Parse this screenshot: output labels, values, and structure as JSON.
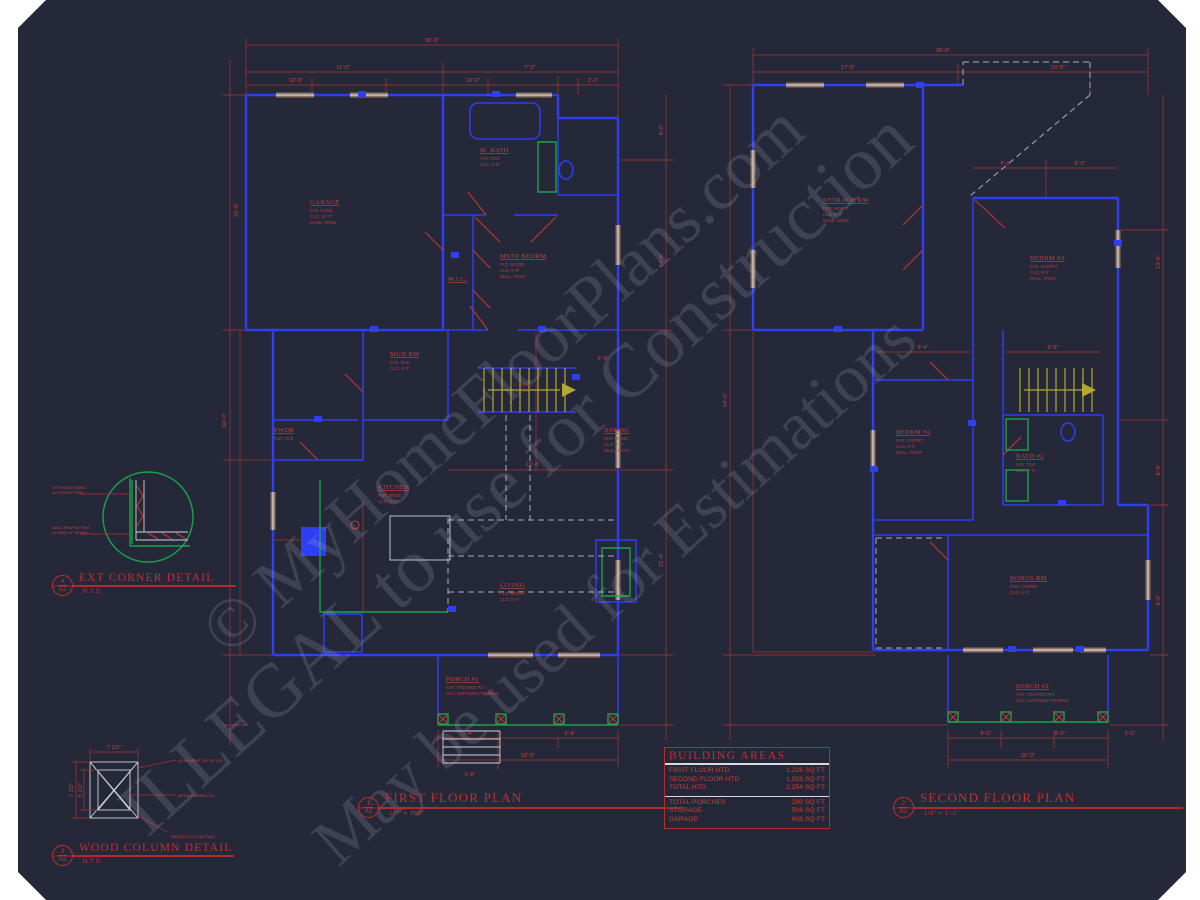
{
  "sheet": {
    "bg": "#252839",
    "accent_blue": "#2e3ef2",
    "accent_red": "#c23636",
    "accent_green": "#1aa24a",
    "watermark": [
      "© MyHomeFloorPlans.com",
      "ILLEGAL to use for Construction",
      "May be used for Estimations"
    ]
  },
  "first_floor": {
    "title": "FIRST FLOOR PLAN",
    "scale": "1/4\" = 1'-0\"",
    "marker_num": "1",
    "marker_sheet": "A2",
    "stairs1": "17 RISERS",
    "stairs2": "@ 7 3/4\"",
    "rooms": [
      {
        "n": "GARAGE",
        "a": "FLR:  CONC",
        "b": "CLG:  10'-0\"",
        "c": "BASE:  NONE"
      },
      {
        "n": "M. BATH",
        "a": "FLR:  TILE",
        "b": "CLG:  9'-0\"",
        "c": ""
      },
      {
        "n": "W.I.C.",
        "a": "",
        "b": "",
        "c": ""
      },
      {
        "n": "MSTR BEDRM",
        "a": "FLR:  WOOD",
        "b": "CLG:  9'-0\"",
        "c": "WALL:  PAINT"
      },
      {
        "n": "MUD RM",
        "a": "FLR:  TILE",
        "b": "CLG:  9'-0\"",
        "c": ""
      },
      {
        "n": "PWDR",
        "a": "FLR:  TILE",
        "b": "CLG:  9'-0\"",
        "c": ""
      },
      {
        "n": "KITCHEN",
        "a": "FLR:  WOOD",
        "b": "CLG:  9'-0\"",
        "c": ""
      },
      {
        "n": "DINING",
        "a": "FLR:  WOOD",
        "b": "CLG:  9'-0\"",
        "c": "WALL:  PAINT"
      },
      {
        "n": "LIVING",
        "a": "FLR:  WOOD",
        "b": "CLG:  9'-0\"",
        "c": "WALL:  PAINT"
      },
      {
        "n": "PORCH #1",
        "a": "FLR:  TREATED PLY",
        "b": "CLG:  EXPOSED FRAMING",
        "c": ""
      }
    ],
    "dims": [
      "30'-8\"",
      "11'-0\"",
      "7'-2\"",
      "10'-8\"",
      "10'-8\"",
      "3'-0\"",
      "60'-0\"",
      "8'-0\"",
      "14'-6\"",
      "21'-4\"",
      "5'-4\"",
      "9'-4\"",
      "18'-0\"",
      "2'-8\"",
      "19'-8\"",
      "9'-8\"",
      "23'-6\""
    ]
  },
  "second_floor": {
    "title": "SECOND FLOOR PLAN",
    "scale": "1/4\" = 1'-0\"",
    "marker_num": "2",
    "marker_sheet": "A2",
    "rooms": [
      {
        "n": "STORAGE RM",
        "a": "FLR:  WOOD",
        "b": "CLG:  8'-0\"",
        "c": "BASE:  NONE"
      },
      {
        "n": "BEDRM #3",
        "a": "FLR:  CARPET",
        "b": "CLG:  9'-0\"",
        "c": "WALL:  PAINT"
      },
      {
        "n": "BEDRM #2",
        "a": "FLR:  CARPET",
        "b": "CLG:  9'-0\"",
        "c": "WALL:  PAINT"
      },
      {
        "n": "BATH #2",
        "a": "FLR:  TILE",
        "b": "CLG:  9'-0\"",
        "c": ""
      },
      {
        "n": "BONUS RM",
        "a": "FLR:  CARPET",
        "b": "CLG:  9'-0\"",
        "c": ""
      },
      {
        "n": "PORCH #2",
        "a": "FLR:  TREATED PLY",
        "b": "CLG:  EXPOSED FRAMING",
        "c": ""
      }
    ],
    "dims": [
      "30'-8\"",
      "17'-0\"",
      "10'-8\"",
      "8'-0\"",
      "8'-0\"",
      "54'-0\"",
      "13'-4\"",
      "8'-4\"",
      "8'-0\"",
      "8'-0\"",
      "8'-0\"",
      "26'-0\"",
      "3'-0\"",
      "9'-4\"",
      "9'-8\""
    ]
  },
  "details": {
    "ext_corner": {
      "title": "EXT CORNER DETAIL",
      "scale": "N.T.S.",
      "marker_num": "4",
      "marker_sheet": "A2",
      "n1a": "EXT WOOD SIDING",
      "n1b": "W/ CORNER TRIM",
      "n2a": "WALL WRAP W/ TRIM",
      "n2b": "AT BACK OF SIDING"
    },
    "wood_column": {
      "title": "WOOD COLUMN DETAIL",
      "scale": "N.T.S.",
      "marker_num": "3",
      "marker_sheet": "A2",
      "dim_top": "7 1/2\"",
      "dim_left": "7 1/2\"",
      "dim_inner": "5 1/2\"",
      "note1": "ALUM WRAP TOP OF COL",
      "note2": "METAL FRAMED COL",
      "note3": "TREATED POST BEYOND"
    }
  },
  "building_areas": {
    "title": "BUILDING AREAS",
    "rows": [
      {
        "label": "FIRST FLOOR HTD",
        "value": "1,226 SQ FT"
      },
      {
        "label": "SECOND FLOOR  HTD",
        "value": "1,028 SQ FT"
      },
      {
        "label": "TOTAL HTD",
        "value": "2,254 SQ FT"
      }
    ],
    "rows2": [
      {
        "label": "TOTAL PORCHES",
        "value": "280 SQ FT"
      },
      {
        "label": "STORAGE",
        "value": "508 SQ FT"
      },
      {
        "label": "GARAGE",
        "value": "608 SQ FT"
      }
    ]
  }
}
